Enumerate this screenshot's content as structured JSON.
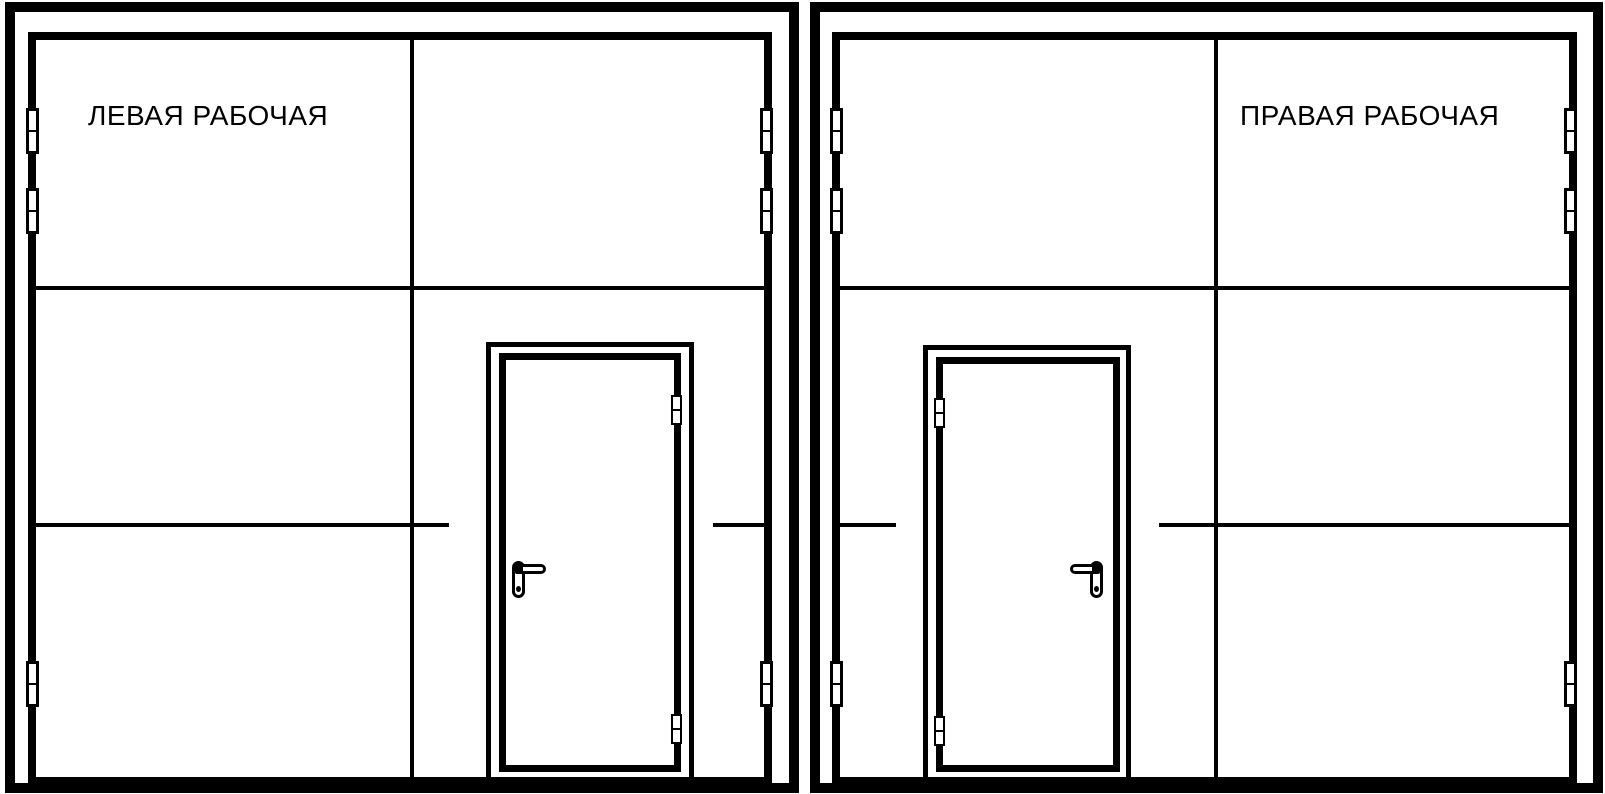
{
  "page": {
    "background_color": "#ffffff",
    "stroke_color": "#000000",
    "description_labels_language": "Russian"
  },
  "diagrams": {
    "left": {
      "label": "ЛЕВАЯ РАБОЧАЯ"
    },
    "right": {
      "label": "ПРАВАЯ РАБОЧАЯ"
    }
  }
}
